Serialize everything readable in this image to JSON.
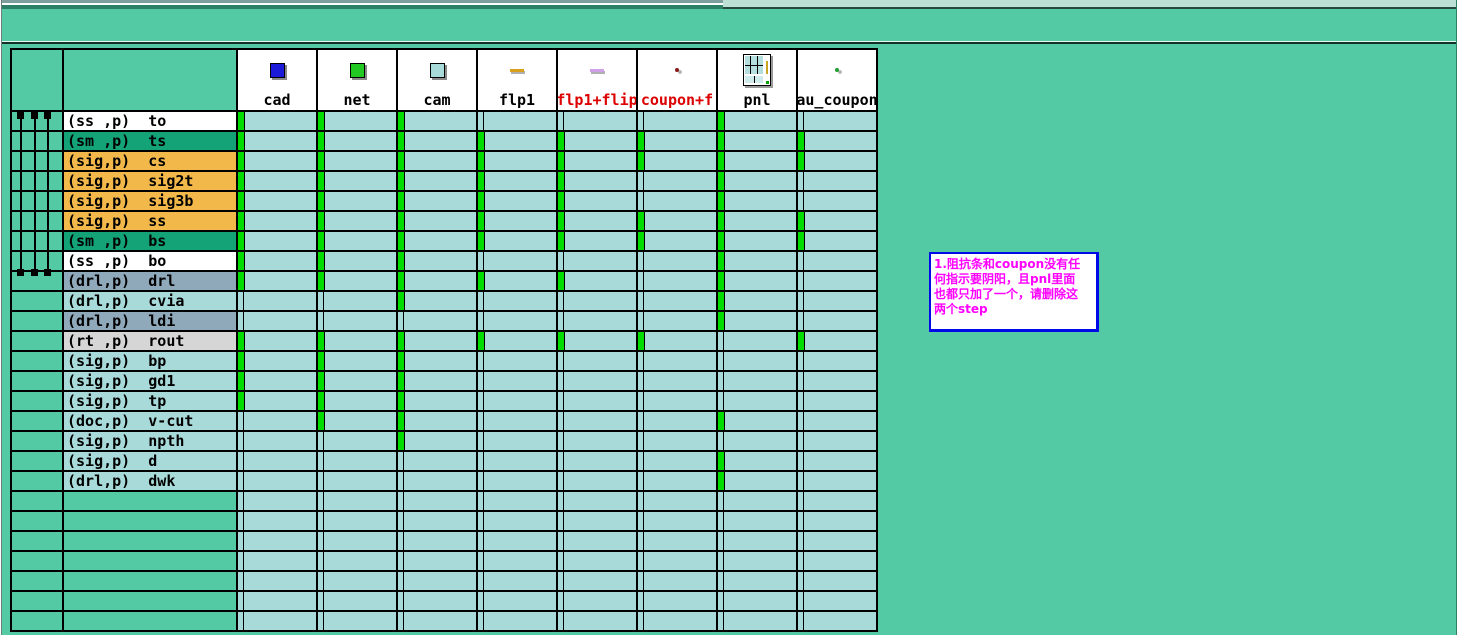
{
  "colors": {
    "background_teal": "#53c9a4",
    "cell_cyan": "#a9dada",
    "presence_green": "#00dc00",
    "grid_black": "#000000",
    "header_red_label": "#dd0000",
    "note_border_blue": "#0009e8",
    "note_text_magenta": "#ff00ff"
  },
  "matrix": {
    "steps": [
      {
        "name": "cad",
        "label": "cad",
        "label_color": "#000000",
        "icon": {
          "type": "square",
          "color": "#1a1ad8"
        }
      },
      {
        "name": "net",
        "label": "net",
        "label_color": "#000000",
        "icon": {
          "type": "square",
          "color": "#22c922"
        }
      },
      {
        "name": "cam",
        "label": "cam",
        "label_color": "#000000",
        "icon": {
          "type": "square",
          "color": "#a9dada"
        }
      },
      {
        "name": "flp1",
        "label": "flp1",
        "label_color": "#000000",
        "icon": {
          "type": "dash",
          "color": "#d8a01c"
        }
      },
      {
        "name": "flp1+flip",
        "label": "flp1+flip",
        "label_color": "#dd0000",
        "icon": {
          "type": "dash",
          "color": "#cfa0e8"
        }
      },
      {
        "name": "coupon+f",
        "label": "coupon+f",
        "label_color": "#dd0000",
        "icon": {
          "type": "dot",
          "color": "#8a1a1a"
        }
      },
      {
        "name": "pnl",
        "label": "pnl",
        "label_color": "#000000",
        "icon": {
          "type": "panel",
          "color": "#b5dede"
        }
      },
      {
        "name": "au_coupon",
        "label": "au_coupon",
        "label_color": "#000000",
        "icon": {
          "type": "dot",
          "color": "#1fa02f"
        }
      }
    ],
    "layers": [
      {
        "ctx": "(ss ,p)",
        "name": "to",
        "bg": "#ffffff",
        "cells": [
          1,
          1,
          1,
          0,
          0,
          0,
          1,
          0
        ]
      },
      {
        "ctx": "(sm ,p)",
        "name": "ts",
        "bg": "#13a376",
        "cells": [
          1,
          1,
          1,
          1,
          1,
          1,
          1,
          1
        ]
      },
      {
        "ctx": "(sig,p)",
        "name": "cs",
        "bg": "#f2b84a",
        "cells": [
          1,
          1,
          1,
          1,
          1,
          1,
          1,
          1
        ]
      },
      {
        "ctx": "(sig,p)",
        "name": "sig2t",
        "bg": "#f2b84a",
        "cells": [
          1,
          1,
          1,
          1,
          1,
          0,
          1,
          0
        ]
      },
      {
        "ctx": "(sig,p)",
        "name": "sig3b",
        "bg": "#f2b84a",
        "cells": [
          1,
          1,
          1,
          1,
          1,
          0,
          1,
          0
        ]
      },
      {
        "ctx": "(sig,p)",
        "name": "ss",
        "bg": "#f2b84a",
        "cells": [
          1,
          1,
          1,
          1,
          1,
          1,
          1,
          1
        ]
      },
      {
        "ctx": "(sm ,p)",
        "name": "bs",
        "bg": "#13a376",
        "cells": [
          1,
          1,
          1,
          1,
          1,
          1,
          1,
          1
        ]
      },
      {
        "ctx": "(ss ,p)",
        "name": "bo",
        "bg": "#ffffff",
        "cells": [
          1,
          1,
          1,
          0,
          0,
          0,
          1,
          0
        ]
      },
      {
        "ctx": "(drl,p)",
        "name": "drl",
        "bg": "#8fa8ba",
        "cells": [
          1,
          1,
          1,
          1,
          1,
          0,
          1,
          0
        ]
      },
      {
        "ctx": "(drl,p)",
        "name": "cvia",
        "bg": "#a9dada",
        "cells": [
          0,
          0,
          1,
          0,
          0,
          0,
          1,
          0
        ]
      },
      {
        "ctx": "(drl,p)",
        "name": "ldi",
        "bg": "#8fa8ba",
        "cells": [
          0,
          0,
          0,
          0,
          0,
          0,
          1,
          0
        ]
      },
      {
        "ctx": "(rt ,p)",
        "name": "rout",
        "bg": "#d6d6d6",
        "cells": [
          1,
          1,
          1,
          1,
          1,
          1,
          0,
          1
        ]
      },
      {
        "ctx": "(sig,p)",
        "name": "bp",
        "bg": "#a9dada",
        "cells": [
          1,
          1,
          1,
          0,
          0,
          0,
          0,
          0
        ]
      },
      {
        "ctx": "(sig,p)",
        "name": "gd1",
        "bg": "#a9dada",
        "cells": [
          1,
          1,
          1,
          0,
          0,
          0,
          0,
          0
        ]
      },
      {
        "ctx": "(sig,p)",
        "name": "tp",
        "bg": "#a9dada",
        "cells": [
          1,
          1,
          1,
          0,
          0,
          0,
          0,
          0
        ]
      },
      {
        "ctx": "(doc,p)",
        "name": "v-cut",
        "bg": "#a9dada",
        "cells": [
          0,
          1,
          1,
          0,
          0,
          0,
          1,
          0
        ]
      },
      {
        "ctx": "(sig,p)",
        "name": "npth",
        "bg": "#a9dada",
        "cells": [
          0,
          0,
          1,
          0,
          0,
          0,
          0,
          0
        ]
      },
      {
        "ctx": "(sig,p)",
        "name": "d",
        "bg": "#a9dada",
        "cells": [
          0,
          0,
          0,
          0,
          0,
          0,
          1,
          0
        ]
      },
      {
        "ctx": "(drl,p)",
        "name": "dwk",
        "bg": "#a9dada",
        "cells": [
          0,
          0,
          0,
          0,
          0,
          0,
          1,
          0
        ]
      }
    ],
    "empty_row_count": 7,
    "span_indicator": {
      "line_count": 3,
      "from_layer": "to",
      "to_layer": "bo"
    }
  },
  "note": {
    "lines": [
      "1.阻抗条和coupon没有任",
      "何指示要阴阳，且pnl里面",
      "也都只加了一个，请删除这",
      "两个step"
    ]
  }
}
